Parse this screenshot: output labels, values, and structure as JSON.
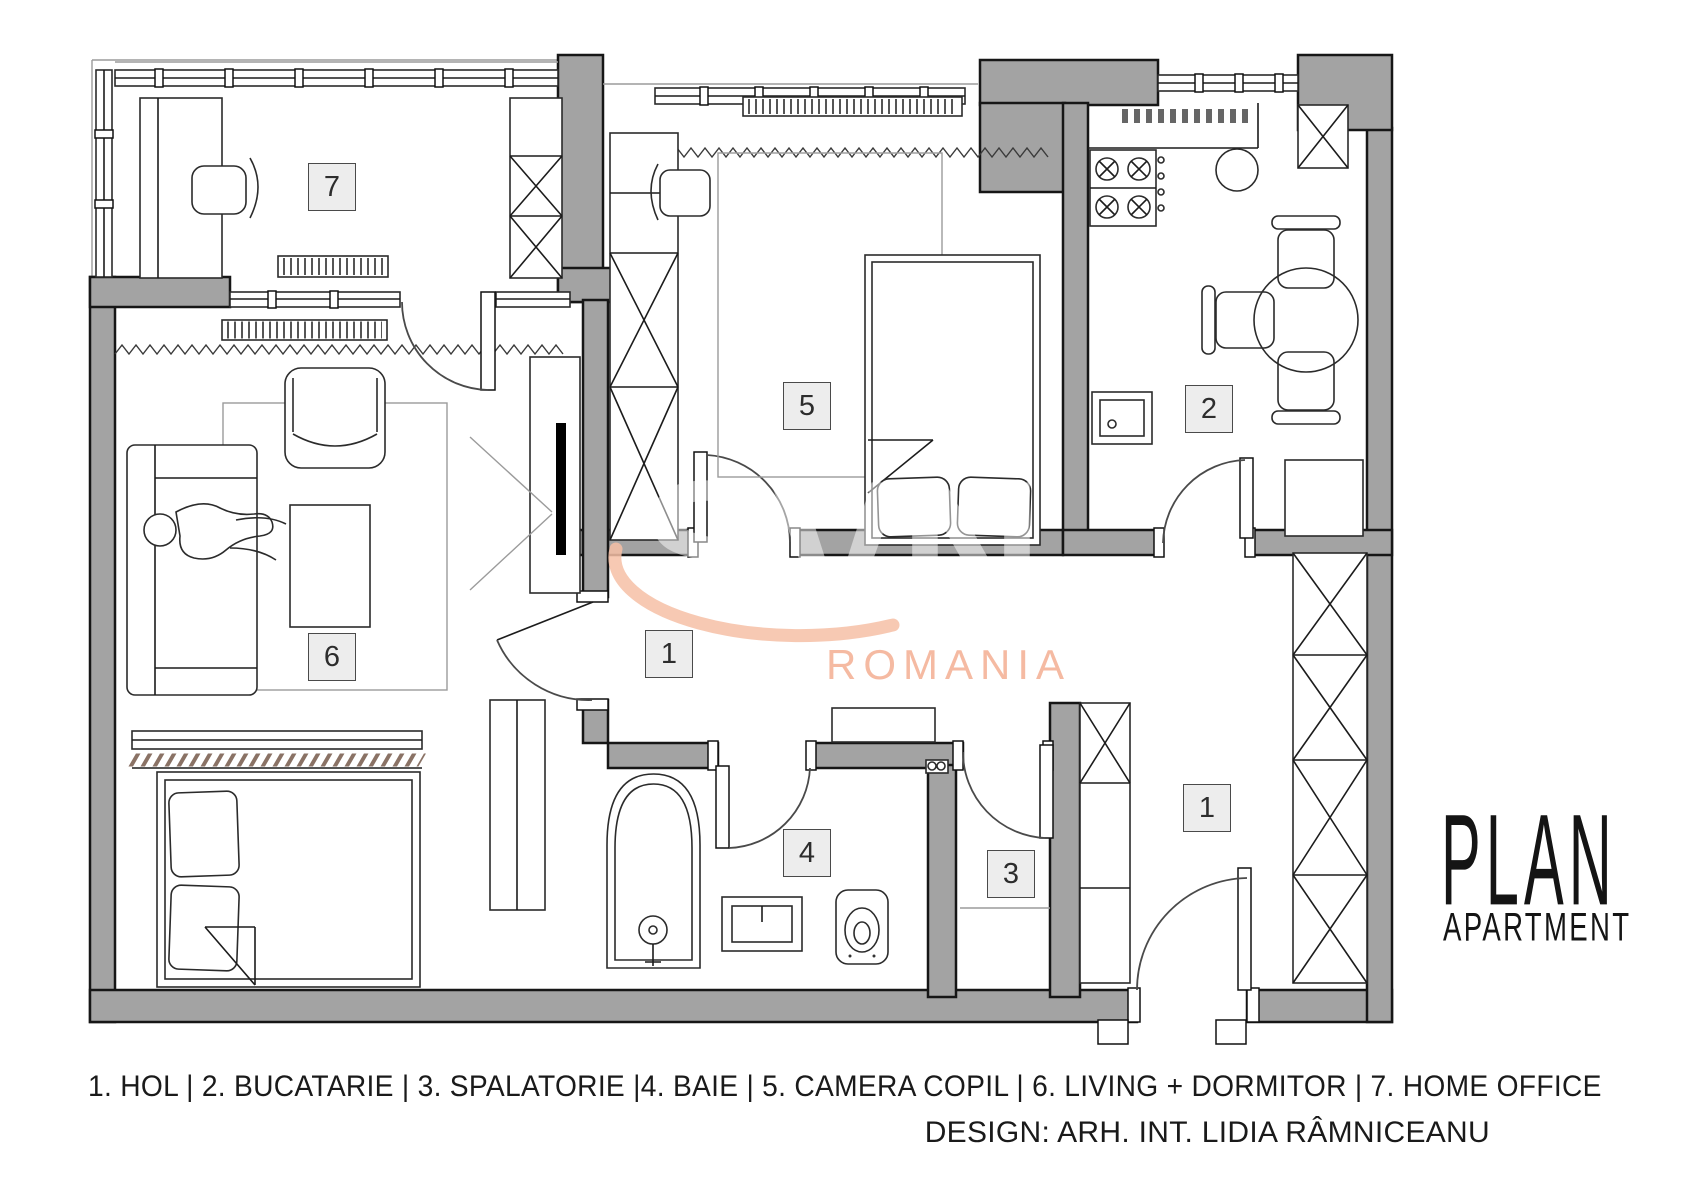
{
  "title": {
    "line1": "PLAN",
    "line2": "APARTMENT"
  },
  "watermark": {
    "brand": "SVN",
    "text": "ROMANIA"
  },
  "legend": {
    "line": "1. HOL | 2. BUCATARIE | 3. SPALATORIE |4. BAIE | 5. CAMERA COPIL | 6. LIVING + DORMITOR | 7. HOME OFFICE",
    "credit": "DESIGN: ARH. INT. LIDIA RÂMNICEANU"
  },
  "rooms": [
    {
      "number": "1",
      "name": "HOL"
    },
    {
      "number": "2",
      "name": "BUCATARIE"
    },
    {
      "number": "3",
      "name": "SPALATORIE"
    },
    {
      "number": "4",
      "name": "BAIE"
    },
    {
      "number": "5",
      "name": "CAMERA COPIL"
    },
    {
      "number": "6",
      "name": "LIVING + DORMITOR"
    },
    {
      "number": "7",
      "name": "HOME OFFICE"
    }
  ],
  "colors": {
    "wall": "#a3a3a3",
    "accent_peach": "#f5b79e",
    "hatch_brown": "#8a7265",
    "label_fill": "#ededed"
  }
}
